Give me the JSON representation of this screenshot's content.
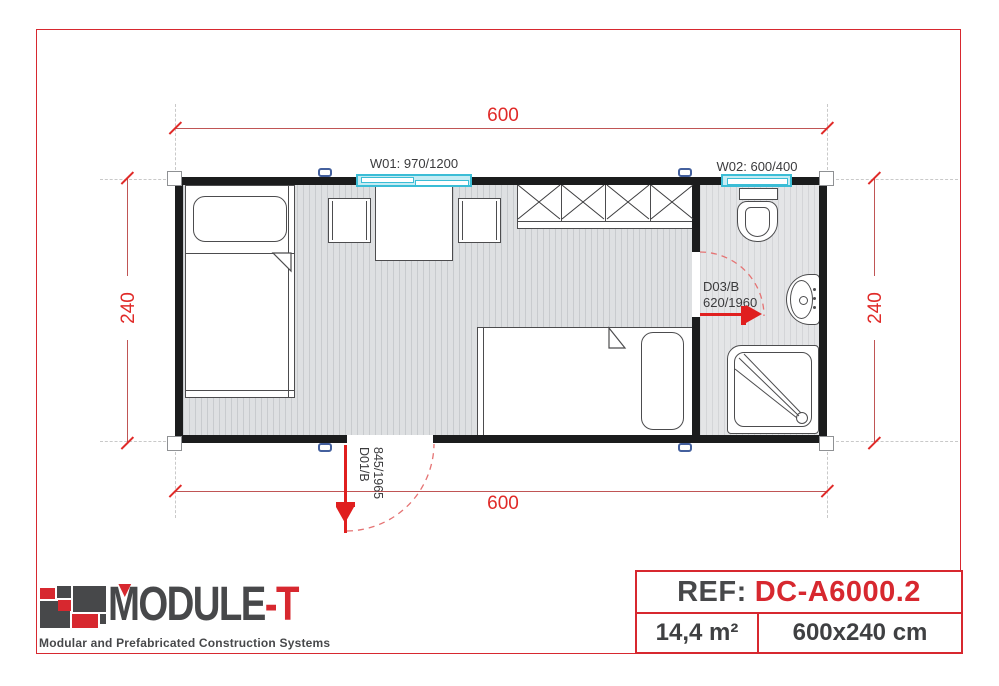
{
  "colors": {
    "accent_red": "#d7282f",
    "dimension_red": "#e02a28",
    "wall_black": "#1b1c1d",
    "window_cyan": "#3bbdd6",
    "text_dark": "#47484a"
  },
  "plan": {
    "dim_top": "600",
    "dim_bottom": "600",
    "dim_left": "240",
    "dim_right": "240",
    "window1_label": "W01: 970/1200",
    "window2_label": "W02: 600/400",
    "door1_line1": "D01/B",
    "door1_line2": "845/1965",
    "door3_line1": "D03/B",
    "door3_line2": "620/1960"
  },
  "footer": {
    "logo_text_main": "MODULE",
    "logo_text_accent": "-T",
    "tagline": "Modular and Prefabricated Construction Systems",
    "ref_label": "REF:",
    "ref_value": "DC-A6000.2",
    "area": "14,4 m²",
    "size": "600x240 cm"
  }
}
